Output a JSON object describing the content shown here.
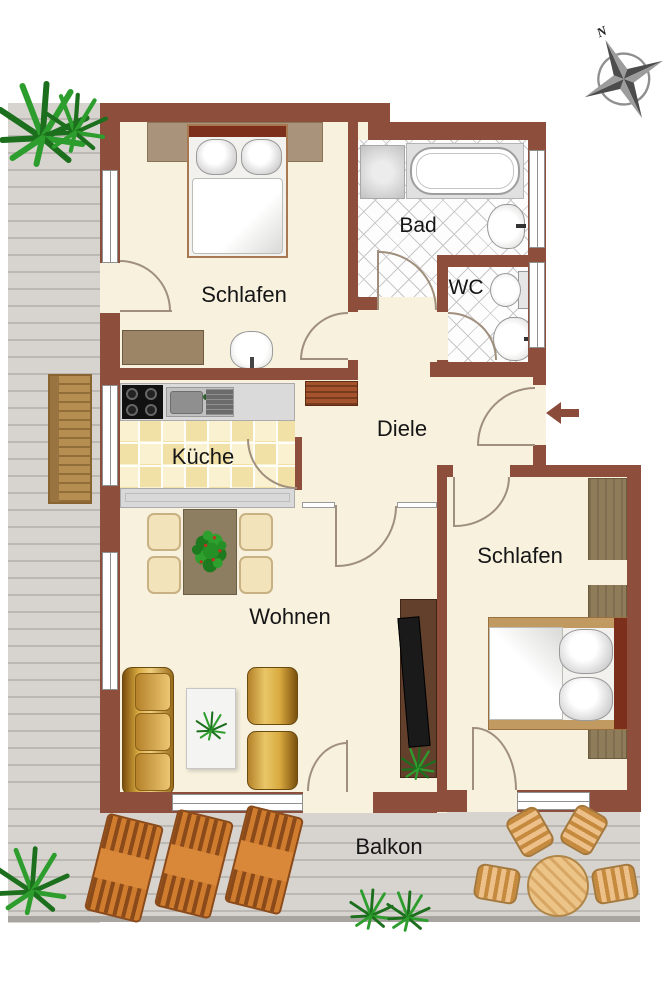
{
  "title": "Apartment floor plan",
  "compass": {
    "north_label": "N"
  },
  "entrance": {
    "symbol": "arrow-left",
    "description": "entry arrow pointing into flat"
  },
  "rooms": {
    "bedroom_top": {
      "label": "Schlafen"
    },
    "bathroom": {
      "label": "Bad"
    },
    "wc": {
      "label": "WC"
    },
    "hallway": {
      "label": "Diele"
    },
    "kitchen": {
      "label": "Küche"
    },
    "living": {
      "label": "Wohnen"
    },
    "bedroom_right": {
      "label": "Schlafen"
    },
    "balcony": {
      "label": "Balkon"
    }
  },
  "furniture": [
    "double-bed-top-bedroom",
    "wardrobe-panel",
    "washbasin-bedroom",
    "sideboard-bedroom",
    "shower",
    "bathtub",
    "bathroom-sink",
    "toilet",
    "wc-sink",
    "hall-shelf",
    "kitchen-counter",
    "stove",
    "kitchen-sink",
    "bar-counter",
    "dining-table",
    "dining-chairs",
    "sofa",
    "coffee-table",
    "armchairs",
    "tv-sideboard",
    "tv",
    "double-bed-right-bedroom",
    "wardrobe-right-bedroom",
    "lounger",
    "lounger",
    "lounger",
    "round-table",
    "balcony-chairs",
    "garden-bench",
    "plants"
  ],
  "colors": {
    "wall": "#8d4e3c",
    "floor": "#f7f1de",
    "deck": "#d7d4cf",
    "kitchen_tile": "#f1e1a6",
    "gold_furniture": "#d8a93f",
    "lounger_orange": "#d07c2e",
    "plant_green": "#1e7a1e",
    "headboard_brown": "#7c301c"
  }
}
